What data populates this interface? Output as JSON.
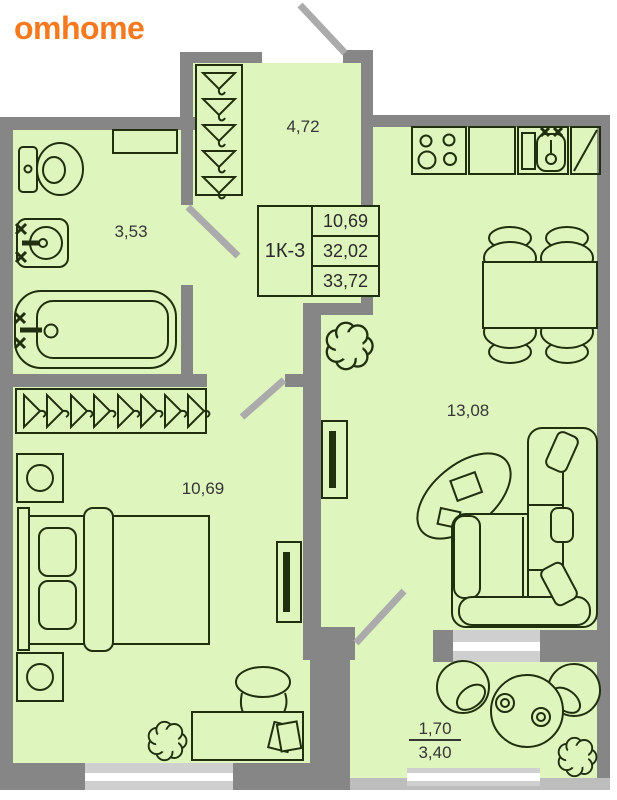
{
  "brand": {
    "name": "omhome",
    "color": "#F4791F"
  },
  "unit_card": {
    "unit": "1К-3",
    "row1": "10,69",
    "row2": "32,02",
    "row3": "33,72"
  },
  "rooms": {
    "hallway": "4,72",
    "bathroom": "3,53",
    "bedroom": "10,69",
    "kitchen_living": "13,08",
    "balcony_reduced": "1,70",
    "balcony_full": "3,40"
  },
  "palette": {
    "room_fill": "#DFF5BE",
    "wall": "#868686",
    "door_swing": "#ABABAB",
    "window": "#CFCFCF",
    "outline": "#20300E"
  }
}
